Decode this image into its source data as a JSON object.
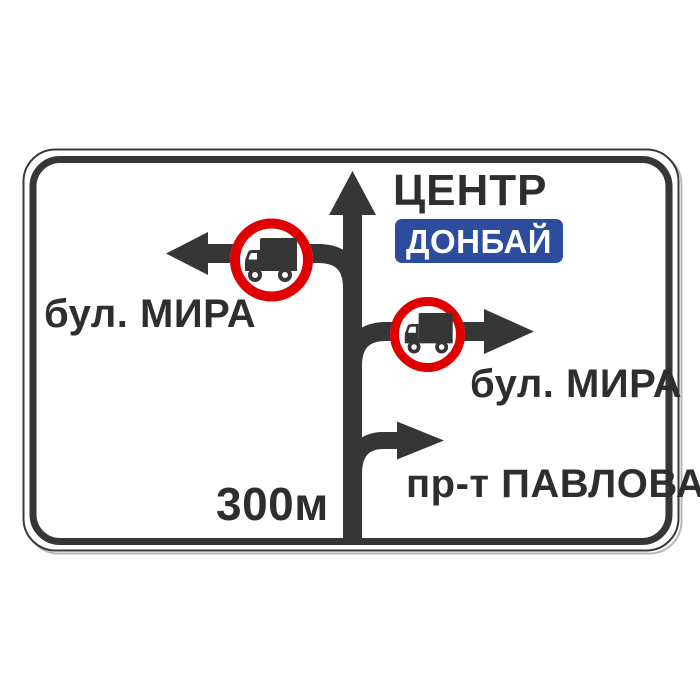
{
  "sign": {
    "kind": "advance-direction-road-sign",
    "directions": {
      "straight": {
        "label": "ЦЕНТР",
        "plate": "ДОНБАЙ"
      },
      "left": {
        "label": "бул. МИРА",
        "restriction_icon": "no-trucks-icon"
      },
      "right": {
        "label": "бул. МИРА",
        "restriction_icon": "no-trucks-icon"
      },
      "secondary_right": {
        "label": "пр-т ПАВЛОВА"
      }
    },
    "distance": "300м",
    "colors": {
      "ink": "#363636",
      "text": "#2e2e2e",
      "red": "#e00000",
      "blue": "#2b4d9c",
      "panel": "#ffffff"
    }
  }
}
